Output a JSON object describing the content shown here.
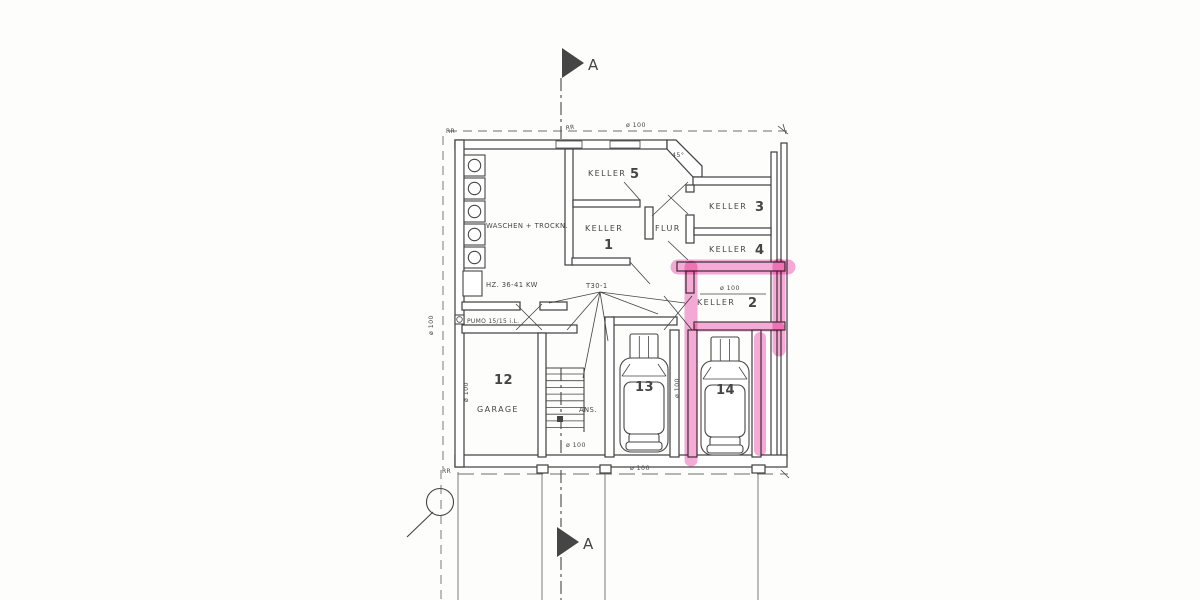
{
  "plan": {
    "section_label_top": "A",
    "section_label_bottom": "A",
    "rooms": {
      "waschen": "WASCHEN + TROCKN.",
      "heizung": "HZ. 36-41 KW",
      "keller1": {
        "label": "KELLER",
        "number": "1"
      },
      "keller2": {
        "label": "KELLER",
        "number": "2"
      },
      "keller3": {
        "label": "KELLER",
        "number": "3"
      },
      "keller4": {
        "label": "KELLER",
        "number": "4"
      },
      "keller5": {
        "label": "KELLER",
        "number": "5"
      },
      "flur": "FLUR",
      "garage_number": "12",
      "garage": "GARAGE",
      "stairs_note": "ANS.",
      "parking13": "13",
      "parking14": "14"
    },
    "annotations": {
      "door_type": "T30-1",
      "pump": "PUMO 15/15 i.L.",
      "angle": "45°",
      "rr_top_left": "RR",
      "rr_top_mid": "RR",
      "rr_bottom_left": "RR"
    },
    "dimensions": {
      "top": "ø 100",
      "left_boundary": "ø 100",
      "garage_wall": "ø 100",
      "keller2": "ø 100",
      "stairs": "ø 100",
      "bottom": "ø 100",
      "stall_divider": "ø 100"
    },
    "colors": {
      "ink": "#454545",
      "paper": "#fdfdfc",
      "highlight": "#ee58b0"
    }
  }
}
